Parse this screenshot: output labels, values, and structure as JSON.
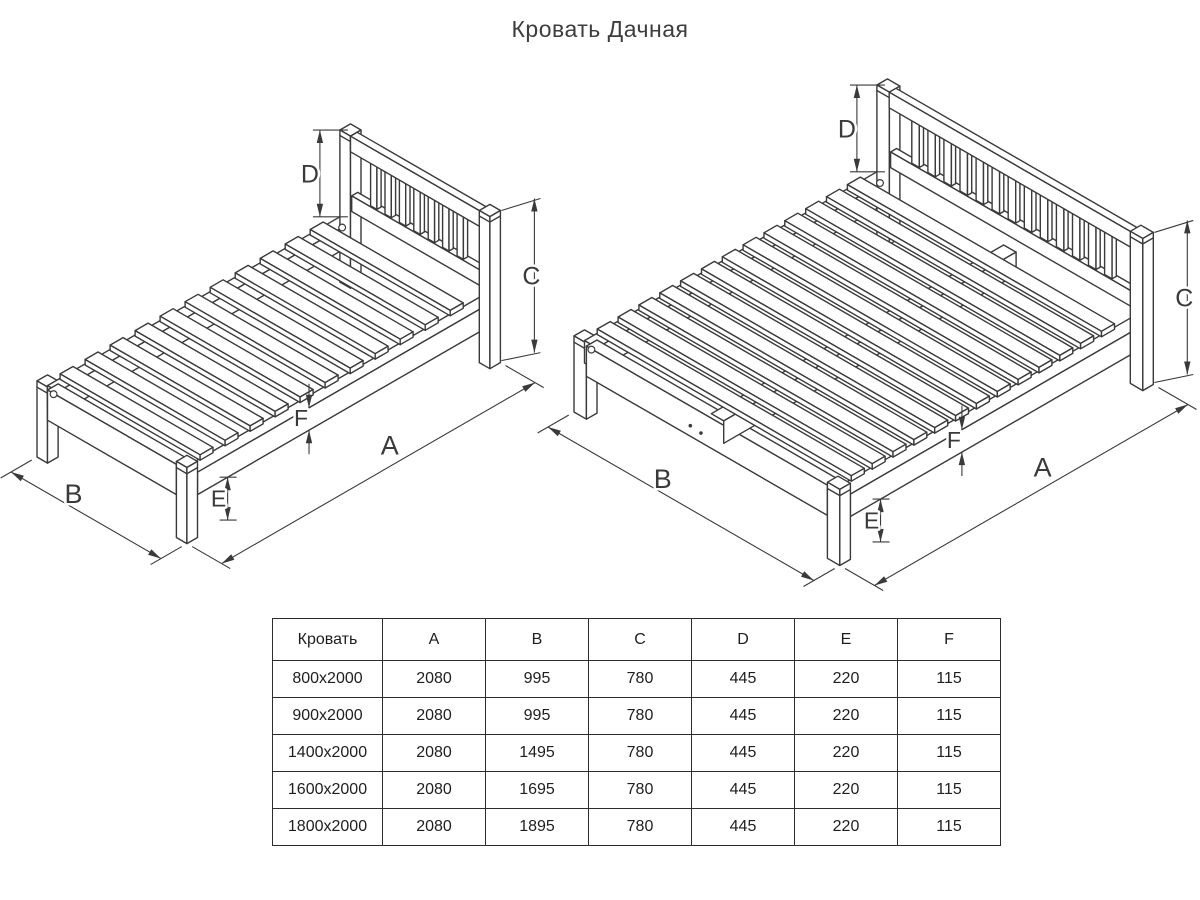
{
  "title": "Кровать Дачная",
  "drawing": {
    "stroke_color": "#3a3a3a",
    "dim_labels": {
      "A": "A",
      "B": "B",
      "C": "C",
      "D": "D",
      "E": "E",
      "F": "F"
    },
    "beds": [
      {
        "name": "single-bed",
        "A": 2080,
        "B": 995,
        "C": 780,
        "D": 445,
        "E": 220,
        "F": 115,
        "slats": 11,
        "spindles": 7,
        "center_rail": false,
        "foot_dots": false
      },
      {
        "name": "double-bed",
        "A": 2080,
        "B": 1495,
        "C": 780,
        "D": 445,
        "E": 220,
        "F": 115,
        "slats": 13,
        "spindles": 13,
        "center_rail": true,
        "foot_dots": true
      }
    ]
  },
  "table": {
    "columns": [
      "Кровать",
      "A",
      "B",
      "C",
      "D",
      "E",
      "F"
    ],
    "rows": [
      [
        "800x2000",
        "2080",
        "995",
        "780",
        "445",
        "220",
        "115"
      ],
      [
        "900x2000",
        "2080",
        "995",
        "780",
        "445",
        "220",
        "115"
      ],
      [
        "1400x2000",
        "2080",
        "1495",
        "780",
        "445",
        "220",
        "115"
      ],
      [
        "1600x2000",
        "2080",
        "1695",
        "780",
        "445",
        "220",
        "115"
      ],
      [
        "1800x2000",
        "2080",
        "1895",
        "780",
        "445",
        "220",
        "115"
      ]
    ]
  }
}
